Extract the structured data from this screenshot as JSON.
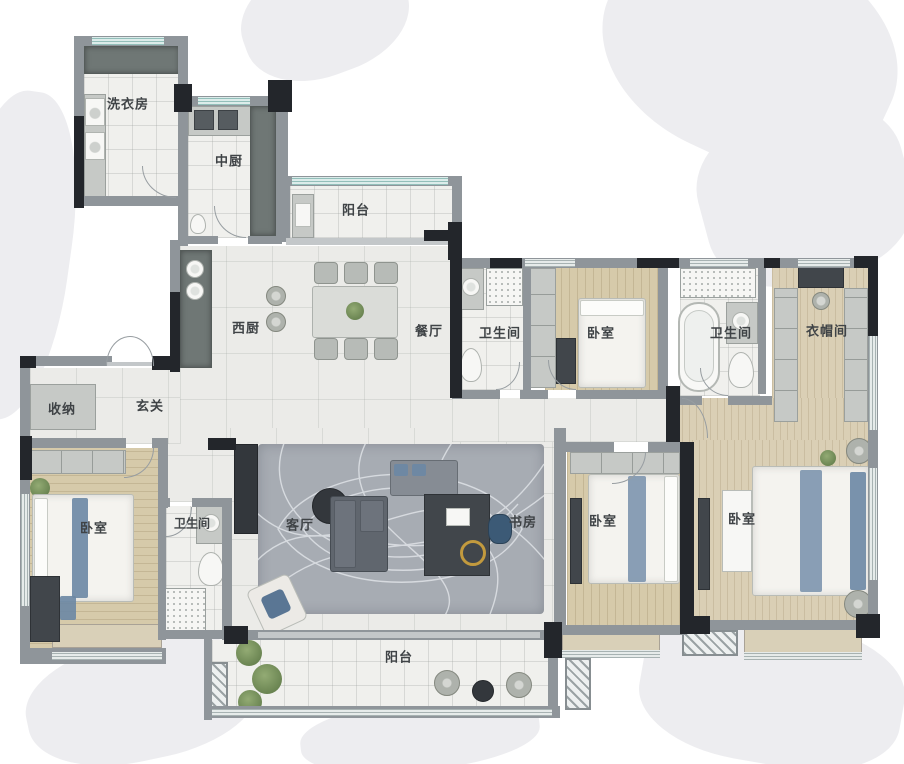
{
  "rooms": [
    {
      "id": "laundry",
      "label": "洗衣房"
    },
    {
      "id": "kitchen-cn",
      "label": "中厨"
    },
    {
      "id": "balcony-top",
      "label": "阳台"
    },
    {
      "id": "west-kitchen",
      "label": "西厨"
    },
    {
      "id": "dining",
      "label": "餐厅"
    },
    {
      "id": "bath-1",
      "label": "卫生间"
    },
    {
      "id": "bed-top",
      "label": "卧室"
    },
    {
      "id": "bath-2",
      "label": "卫生间"
    },
    {
      "id": "closet",
      "label": "衣帽间"
    },
    {
      "id": "storage",
      "label": "收纳"
    },
    {
      "id": "foyer",
      "label": "玄关"
    },
    {
      "id": "bed-left",
      "label": "卧室"
    },
    {
      "id": "bath-3",
      "label": "卫生间"
    },
    {
      "id": "living",
      "label": "客厅"
    },
    {
      "id": "study",
      "label": "书房"
    },
    {
      "id": "bed-mid",
      "label": "卧室"
    },
    {
      "id": "bed-master",
      "label": "卧室"
    },
    {
      "id": "balcony-bottom",
      "label": "阳台"
    }
  ],
  "palette": {
    "wall_black": "#23262b",
    "wall_gray": "#8f959a",
    "wood_floor": "#d6caaa",
    "tile_floor": "#f0f0ed",
    "rug_gray": "#a7acb3",
    "accent_blue": "#6c87a4",
    "plant_green": "#6d8b55",
    "label_text": "#3f4346"
  }
}
